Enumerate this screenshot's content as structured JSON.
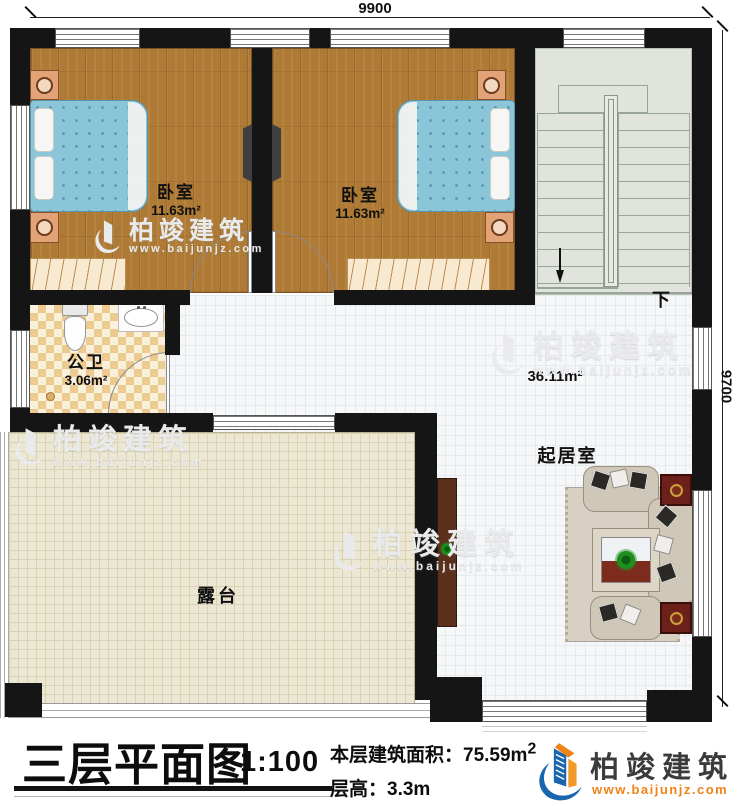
{
  "plan": {
    "dim_top": "9900",
    "dim_right": "9700",
    "rooms": {
      "bedroom1": {
        "name": "卧室",
        "area": "11.63m²"
      },
      "bedroom2": {
        "name": "卧室",
        "area": "11.63m²"
      },
      "bathroom": {
        "name": "公卫",
        "area": "3.06m²"
      },
      "living": {
        "name": "起居室",
        "area": "36.11m²"
      },
      "terrace": {
        "name": "露台"
      },
      "stairs": {
        "down": "下"
      }
    }
  },
  "title_block": {
    "title": "三层平面图",
    "scale": "1:100",
    "floor_area_label": "本层建筑面积：",
    "floor_area_value": "75.59m",
    "floor_area_sup": "2",
    "floor_height": "层高：3.3m"
  },
  "branding": {
    "company": "柏竣建筑",
    "website": "www.baijunjz.com",
    "brand_blue": "#1a66ae",
    "brand_orange": "#ef8318"
  },
  "watermark": {
    "company": "柏竣建筑",
    "website": "www.baijunjz.com"
  },
  "colors": {
    "wall": "#151515",
    "wood_floor": "#ae7a35",
    "bed": "#8ac6d8",
    "bath_tile": "#ecca90",
    "stair_floor": "#e0e4dd",
    "terrace_floor": "#ece7d2"
  }
}
